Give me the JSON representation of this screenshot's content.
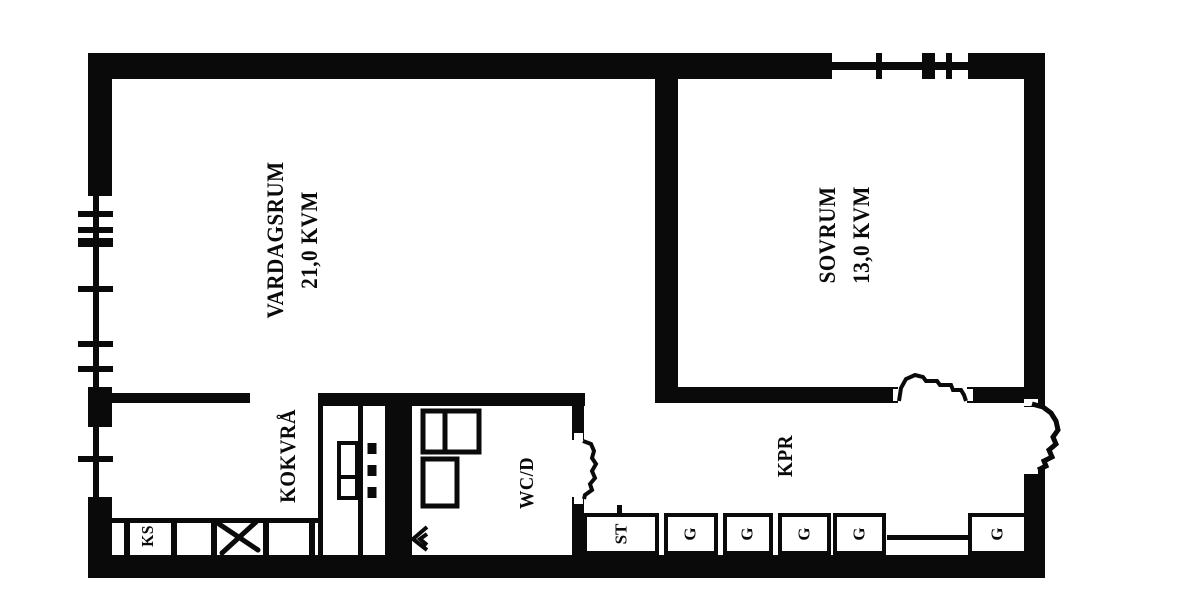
{
  "colors": {
    "ink": "#0a0a0a",
    "paper": "#ffffff"
  },
  "rooms": {
    "vardagsrum": {
      "name": "VARDAGSRUM",
      "area": "21,0 KVM"
    },
    "sovrum": {
      "name": "SOVRUM",
      "area": "13,0 KVM"
    },
    "kokvra": {
      "name": "KOKVRÅ"
    },
    "wc": {
      "name": "WC/D"
    },
    "kpr": {
      "name": "KPR"
    }
  },
  "fixtures": {
    "fridge_label": "KS",
    "cleaning_label": "ST",
    "wardrobes": [
      "G",
      "G",
      "G",
      "G",
      "G"
    ]
  }
}
